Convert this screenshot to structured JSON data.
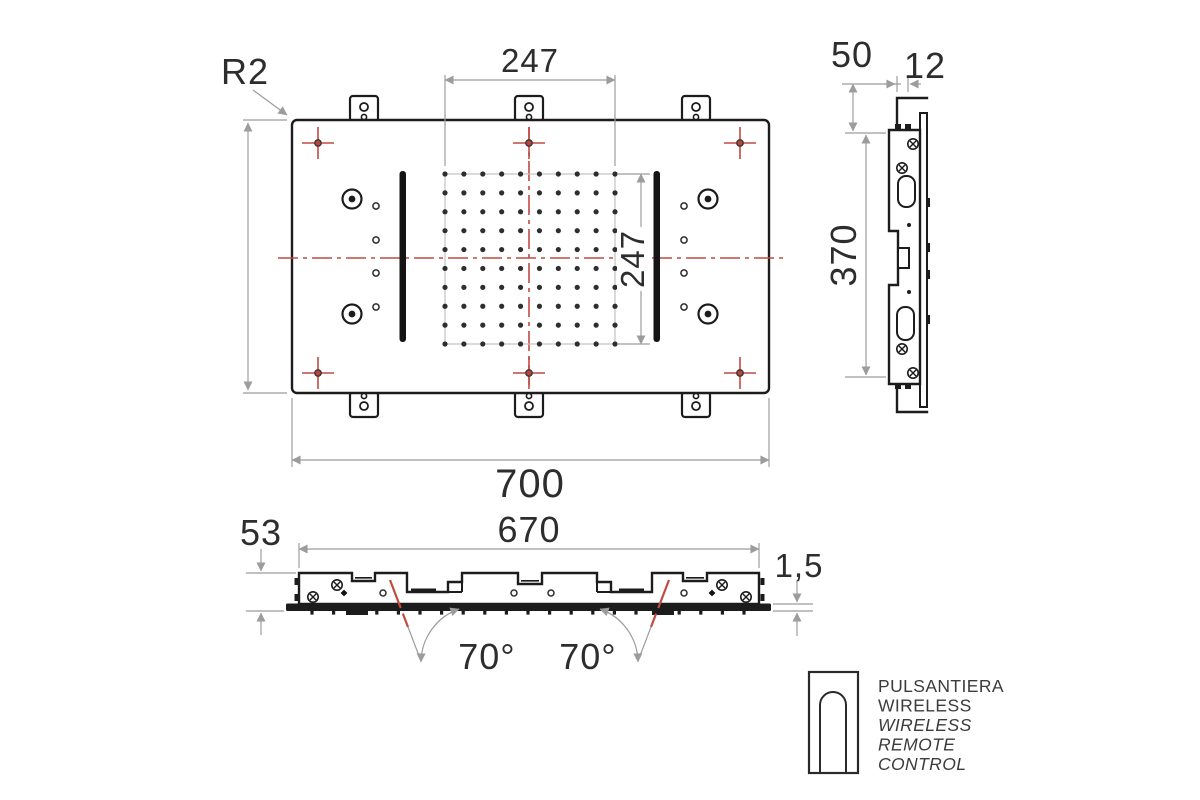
{
  "views": {
    "plan": {
      "corner_radius": "R2",
      "grid_width": "247",
      "grid_height": "247",
      "plate_width": "700"
    },
    "side": {
      "flange_offset": "50",
      "hook_width": "12",
      "height": "370"
    },
    "front": {
      "recess_depth": "53",
      "body_width": "670",
      "plate_thickness": "1,5",
      "spray_angle_left": "70°",
      "spray_angle_right": "70°"
    }
  },
  "legend": {
    "icon": "wireless-remote-outline",
    "lines": [
      "PULSANTIERA",
      "WIRELESS",
      "WIRELESS",
      "REMOTE",
      "CONTROL"
    ]
  },
  "colors": {
    "line": "#1c1c1c",
    "dimension": "#9c9c9c",
    "centerline": "#c04b40",
    "background": "#ffffff",
    "text": "#2d2d2d"
  }
}
